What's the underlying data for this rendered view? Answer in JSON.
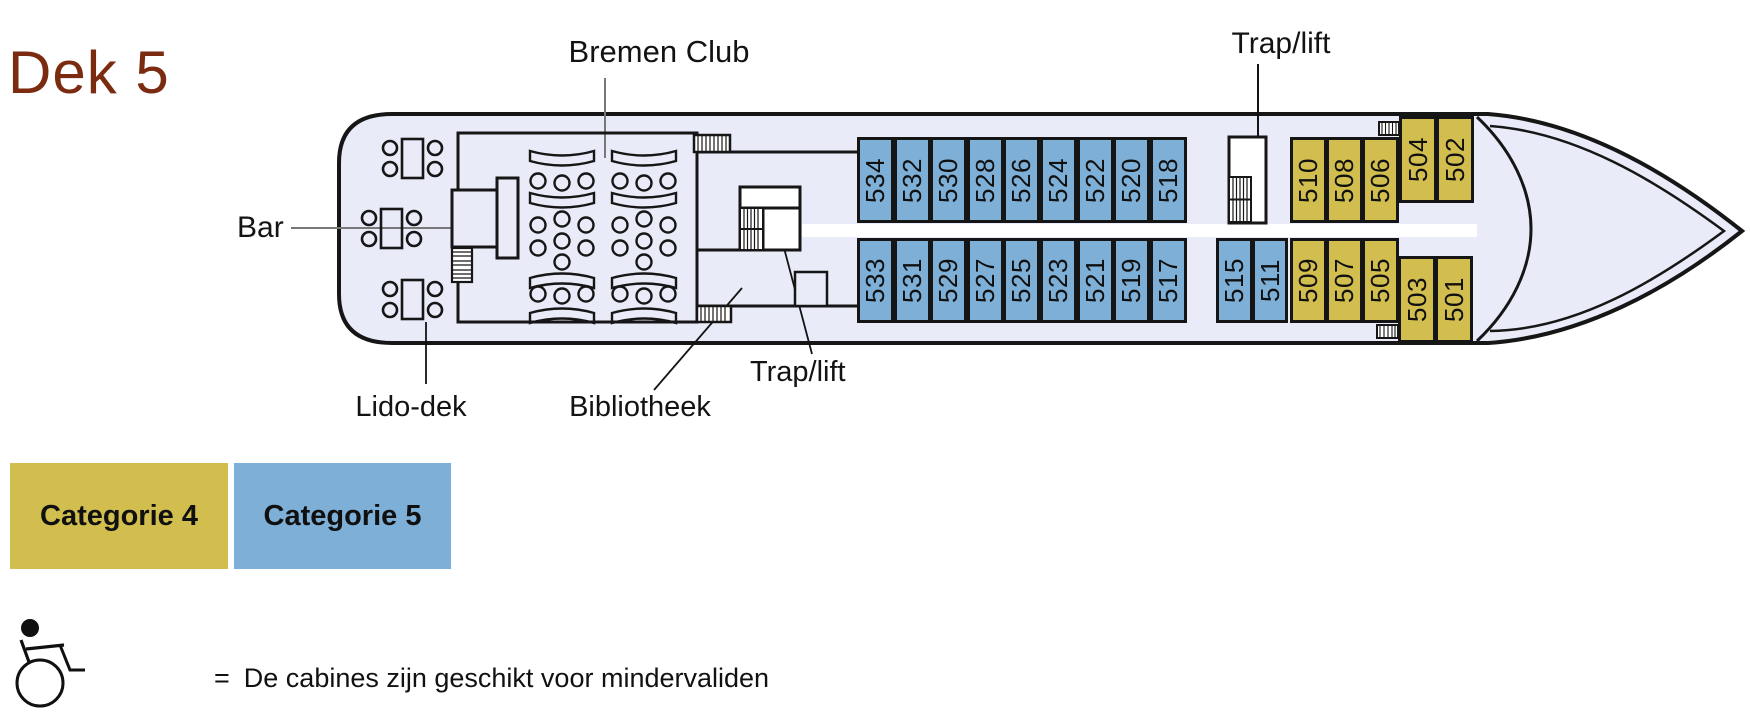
{
  "title": {
    "text": "Dek 5",
    "color": "#7B2B10"
  },
  "labels": {
    "bremen_club": "Bremen Club",
    "trap_lift_top": "Trap/lift",
    "trap_lift_bottom": "Trap/lift",
    "bar": "Bar",
    "lido_dek": "Lido-dek",
    "bibliotheek": "Bibliotheek"
  },
  "legend": {
    "items": [
      {
        "label": "Categorie 4",
        "color": "#D2BE4E"
      },
      {
        "label": "Categorie 5",
        "color": "#7DAFD7"
      }
    ],
    "wheelchair_note": {
      "icon": "wheelchair-icon",
      "equals": "=",
      "text": "De cabines zijn geschikt voor mindervaliden"
    }
  },
  "colors": {
    "cat4": "#D2BE4E",
    "cat5": "#7DAFD7",
    "deck": "#E9EBF8",
    "outline": "#161616",
    "corridor": "#ffffff"
  },
  "cabins": [
    {
      "number": "534",
      "category": "cat5",
      "x": 857,
      "y": 137,
      "w": 37,
      "h": 86
    },
    {
      "number": "532",
      "category": "cat5",
      "x": 894,
      "y": 137,
      "w": 37,
      "h": 86
    },
    {
      "number": "530",
      "category": "cat5",
      "x": 930,
      "y": 137,
      "w": 37,
      "h": 86
    },
    {
      "number": "528",
      "category": "cat5",
      "x": 967,
      "y": 137,
      "w": 37,
      "h": 86
    },
    {
      "number": "526",
      "category": "cat5",
      "x": 1003,
      "y": 137,
      "w": 37,
      "h": 86
    },
    {
      "number": "524",
      "category": "cat5",
      "x": 1040,
      "y": 137,
      "w": 37,
      "h": 86
    },
    {
      "number": "522",
      "category": "cat5",
      "x": 1077,
      "y": 137,
      "w": 37,
      "h": 86
    },
    {
      "number": "520",
      "category": "cat5",
      "x": 1113,
      "y": 137,
      "w": 37,
      "h": 86
    },
    {
      "number": "518",
      "category": "cat5",
      "x": 1150,
      "y": 137,
      "w": 37,
      "h": 86
    },
    {
      "number": "510",
      "category": "cat4",
      "x": 1290,
      "y": 137,
      "w": 37,
      "h": 86
    },
    {
      "number": "508",
      "category": "cat4",
      "x": 1326,
      "y": 137,
      "w": 37,
      "h": 86
    },
    {
      "number": "506",
      "category": "cat4",
      "x": 1362,
      "y": 137,
      "w": 37,
      "h": 86
    },
    {
      "number": "504",
      "category": "cat4",
      "x": 1399,
      "y": 116,
      "w": 38,
      "h": 87
    },
    {
      "number": "502",
      "category": "cat4",
      "x": 1436,
      "y": 116,
      "w": 38,
      "h": 87
    },
    {
      "number": "533",
      "category": "cat5",
      "x": 857,
      "y": 238,
      "w": 37,
      "h": 85
    },
    {
      "number": "531",
      "category": "cat5",
      "x": 894,
      "y": 238,
      "w": 37,
      "h": 85
    },
    {
      "number": "529",
      "category": "cat5",
      "x": 930,
      "y": 238,
      "w": 37,
      "h": 85
    },
    {
      "number": "527",
      "category": "cat5",
      "x": 967,
      "y": 238,
      "w": 37,
      "h": 85
    },
    {
      "number": "525",
      "category": "cat5",
      "x": 1003,
      "y": 238,
      "w": 37,
      "h": 85
    },
    {
      "number": "523",
      "category": "cat5",
      "x": 1040,
      "y": 238,
      "w": 37,
      "h": 85
    },
    {
      "number": "521",
      "category": "cat5",
      "x": 1077,
      "y": 238,
      "w": 37,
      "h": 85
    },
    {
      "number": "519",
      "category": "cat5",
      "x": 1113,
      "y": 238,
      "w": 37,
      "h": 85
    },
    {
      "number": "517",
      "category": "cat5",
      "x": 1150,
      "y": 238,
      "w": 37,
      "h": 85
    },
    {
      "number": "515",
      "category": "cat5",
      "x": 1216,
      "y": 238,
      "w": 37,
      "h": 85
    },
    {
      "number": "511",
      "category": "cat5",
      "x": 1252,
      "y": 238,
      "w": 36,
      "h": 85
    },
    {
      "number": "509",
      "category": "cat4",
      "x": 1290,
      "y": 238,
      "w": 37,
      "h": 85
    },
    {
      "number": "507",
      "category": "cat4",
      "x": 1326,
      "y": 238,
      "w": 37,
      "h": 85
    },
    {
      "number": "505",
      "category": "cat4",
      "x": 1362,
      "y": 238,
      "w": 37,
      "h": 85
    },
    {
      "number": "503",
      "category": "cat4",
      "x": 1398,
      "y": 256,
      "w": 38,
      "h": 87
    },
    {
      "number": "501",
      "category": "cat4",
      "x": 1435,
      "y": 256,
      "w": 38,
      "h": 87
    }
  ]
}
